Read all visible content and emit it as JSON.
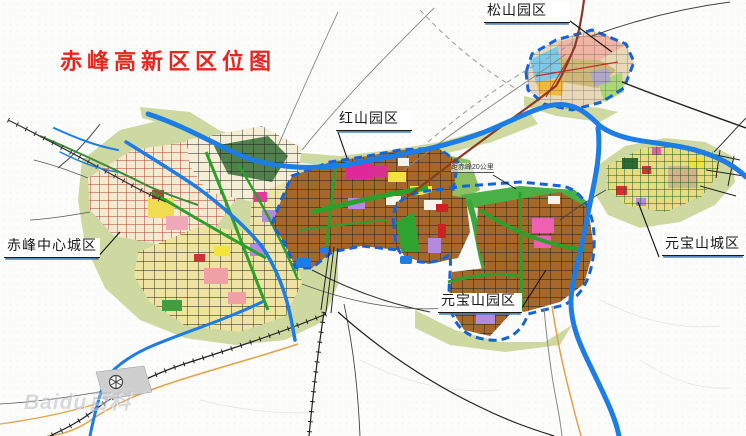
{
  "title": "赤峰高新区区位图",
  "zones": [
    {
      "id": "center-city",
      "label": "赤峰中心城区"
    },
    {
      "id": "hongshan-park",
      "label": "红山园区"
    },
    {
      "id": "songshan-park",
      "label": "松山园区"
    },
    {
      "id": "yuanbaoshan-park",
      "label": "元宝山园区"
    },
    {
      "id": "yuanbaoshan-city",
      "label": "元宝山城区"
    }
  ],
  "annotations": {
    "distance_note": "距赤峰20公里"
  },
  "watermark": {
    "text": "Baidu百科"
  },
  "colors": {
    "title_red": "#e8251f",
    "river_blue": "#1d7de4",
    "boundary_dash_blue": "#1464d8",
    "park_brown": "#a5682a",
    "pale_green": "#cdd9a0",
    "corridor_green": "#2ca02c",
    "city_block_yellow": "#eee3a0",
    "old_town_grid_red": "#b03c32",
    "highway_maroon": "#8c3a22",
    "road_orange": "#e2a24a",
    "patch_magenta": "#e23a9c",
    "patch_purple": "#b28ae0",
    "patch_yellow": "#f2e43c"
  }
}
